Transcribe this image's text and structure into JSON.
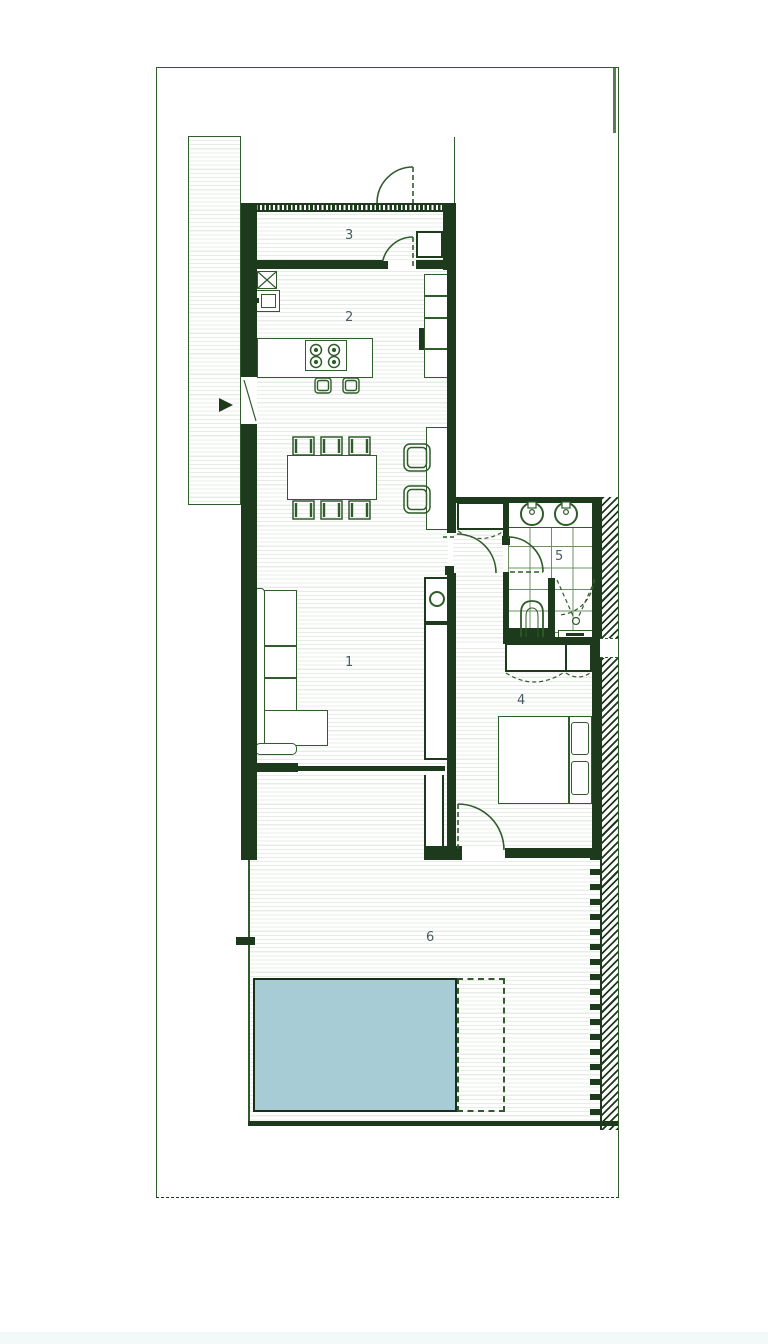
{
  "rooms": [
    {
      "id": "room-1-living",
      "label": "1"
    },
    {
      "id": "room-2-kitchen",
      "label": "2"
    },
    {
      "id": "room-3-entry",
      "label": "3"
    },
    {
      "id": "room-4-bedroom",
      "label": "4"
    },
    {
      "id": "room-5-bathroom",
      "label": "5"
    },
    {
      "id": "room-6-terrace",
      "label": "6"
    }
  ],
  "colors": {
    "wall": "#1e3a1c",
    "line": "#2f5c2a",
    "line2": "#4a7a42",
    "stripe": "#e7ede6",
    "tile": "#6b9062",
    "pool": "#a7ccd5",
    "poolb": "#16301a",
    "label": "#4a5c60",
    "pstrip": "#f3f8f9"
  }
}
